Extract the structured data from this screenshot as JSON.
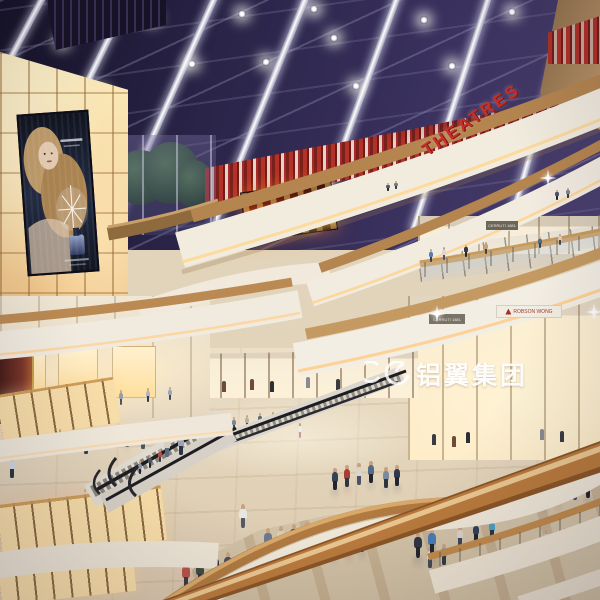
{
  "scene": {
    "title": "shopping-mall-atrium-night-render",
    "watermark": {
      "logo": "swirl-mark",
      "text": "铝翼集团"
    },
    "signs": {
      "theatres": "THEATRES",
      "store_3f": "CERRUTI 1881",
      "store_2f_left": "CERRUTI 1881",
      "store_2f_right": "ROBSON WONG"
    },
    "colors": {
      "sky": "#2a2446",
      "beam_white": "#e8e8f2",
      "red_accent": "#b5322a",
      "wood": "#b5854f",
      "amber_glow": "#f5d9a4",
      "fascia_white": "#f2ecdf",
      "floor_beige": "#e2d4ba",
      "fire_screen_orange": "#ff8a1e",
      "watermark": "#ffffff"
    }
  },
  "people": [
    [
      557,
      200,
      10,
      "#4a5568",
      "#23242e",
      "f"
    ],
    [
      568,
      198,
      10,
      "#7a8698",
      "#333a44",
      "f"
    ],
    [
      388,
      191,
      8,
      "#555a66",
      "#22262e",
      "f"
    ],
    [
      396,
      189,
      8,
      "#787888",
      "#333a44",
      "f"
    ],
    [
      431,
      262,
      13,
      "#5a7ab0",
      "#39404e",
      "f"
    ],
    [
      444,
      260,
      13,
      "#d8d8d8",
      "#4a5266",
      "f"
    ],
    [
      466,
      257,
      12,
      "#333a46",
      "#23242e",
      "f"
    ],
    [
      486,
      254,
      12,
      "#c8a07a",
      "#39404e",
      "f"
    ],
    [
      540,
      248,
      11,
      "#556a88",
      "#334455",
      "f"
    ],
    [
      560,
      245,
      11,
      "#d8ccc0",
      "#444a55",
      "f"
    ],
    [
      100,
      408,
      16,
      "#c89aa0",
      "#4a5266",
      "f"
    ],
    [
      121,
      405,
      15,
      "#8898b0",
      "#39404e",
      "f"
    ],
    [
      148,
      402,
      14,
      "#aab8c4",
      "#333a44",
      "f"
    ],
    [
      170,
      400,
      13,
      "#98a8b8",
      "#444a55",
      "f"
    ],
    [
      221,
      432,
      13,
      "#9aa8b8",
      "#333a44",
      "f"
    ],
    [
      234,
      430,
      13,
      "#7a8698",
      "#444a55",
      "f"
    ],
    [
      247,
      428,
      13,
      "#b8b0a0",
      "#333a44",
      "f"
    ],
    [
      260,
      426,
      13,
      "#5a6878",
      "#22262e",
      "f"
    ],
    [
      273,
      425,
      13,
      "#8a98a8",
      "#333a44",
      "f"
    ],
    [
      58,
      520,
      19,
      "#baa89a",
      "#44506b",
      "f"
    ],
    [
      78,
      515,
      19,
      "#8fa0b5",
      "#333a44",
      "f"
    ],
    [
      42,
      532,
      18,
      "#c8d0b8",
      "#444a55",
      "f"
    ],
    [
      20,
      538,
      18,
      "#a8b8c8",
      "#333a44",
      "f"
    ],
    [
      85,
      506,
      17,
      "#d8c8b8",
      "#444a55",
      "f"
    ],
    [
      335,
      490,
      22,
      "#334455",
      "#23242e",
      "m"
    ],
    [
      347,
      487,
      22,
      "#aa3c36",
      "#2e3440",
      "m"
    ],
    [
      359,
      485,
      22,
      "#d8d5cc",
      "#4a5266",
      "m"
    ],
    [
      371,
      483,
      22,
      "#556a85",
      "#23242e",
      "m"
    ],
    [
      386,
      488,
      21,
      "#7a8ba0",
      "#2e3440",
      "m"
    ],
    [
      397,
      486,
      21,
      "#2e3a4e",
      "#23242e",
      "m"
    ],
    [
      127,
      447,
      19,
      "#b08a88",
      "#444a55",
      "m"
    ],
    [
      143,
      449,
      19,
      "#d8d0a8",
      "#45556a",
      "m"
    ],
    [
      86,
      454,
      19,
      "#c8cdd8",
      "#333a44",
      "m"
    ],
    [
      60,
      447,
      18,
      "#8888aa",
      "#333a44",
      "m"
    ],
    [
      12,
      478,
      21,
      "#d0d8e0",
      "#2e3440",
      "m"
    ],
    [
      167,
      457,
      21,
      "#d8cfc2",
      "#5a6a80",
      "m"
    ],
    [
      181,
      455,
      21,
      "#9aa5b5",
      "#2e3440",
      "m"
    ],
    [
      515,
      510,
      23,
      "#4aa3cc",
      "#2e3440",
      "m"
    ],
    [
      530,
      507,
      23,
      "#d8d0c2",
      "#4a5266",
      "m"
    ],
    [
      545,
      505,
      23,
      "#2f4a6e",
      "#23242e",
      "m"
    ],
    [
      558,
      503,
      23,
      "#8a5a4a",
      "#2e3440",
      "m"
    ],
    [
      575,
      500,
      22,
      "#c8b8a8",
      "#44506b",
      "m"
    ],
    [
      588,
      498,
      22,
      "#3a4a5a",
      "#23242e",
      "m"
    ],
    [
      268,
      552,
      24,
      "#6a7a8e",
      "#2e3440",
      "m"
    ],
    [
      281,
      550,
      24,
      "#d6cec0",
      "#4a5266",
      "m"
    ],
    [
      294,
      548,
      24,
      "#47525f",
      "#23242e",
      "m"
    ],
    [
      307,
      545,
      23,
      "#2e3a4a",
      "#1e2028",
      "m"
    ],
    [
      334,
      558,
      24,
      "#8795a5",
      "#333a44",
      "m"
    ],
    [
      349,
      555,
      24,
      "#b0443a",
      "#2e3440",
      "m"
    ],
    [
      362,
      552,
      24,
      "#3c4654",
      "#23242e",
      "m"
    ],
    [
      430,
      568,
      21,
      "#d8d8d8",
      "#444a55",
      "m"
    ],
    [
      444,
      565,
      21,
      "#8899aa",
      "#333a44",
      "m"
    ],
    [
      418,
      558,
      26,
      "#2e3440",
      "#23242e",
      "m"
    ],
    [
      432,
      555,
      27,
      "#4a7ab5",
      "#23242e",
      "m"
    ],
    [
      460,
      546,
      20,
      "#d8d2c8",
      "#3c4658",
      "m"
    ],
    [
      476,
      542,
      20,
      "#2f3f58",
      "#23242e",
      "m"
    ],
    [
      492,
      538,
      19,
      "#4a9ec4",
      "#2e3440",
      "m"
    ],
    [
      186,
      588,
      27,
      "#b8524a",
      "#3a3a44",
      "m"
    ],
    [
      200,
      586,
      28,
      "#3f4a3f",
      "#2e3440",
      "m"
    ],
    [
      215,
      580,
      27,
      "#2e3846",
      "#23242e",
      "m"
    ],
    [
      228,
      578,
      26,
      "#454f5e",
      "#23242e",
      "m"
    ],
    [
      243,
      528,
      24,
      "#e8e6e0",
      "#555a66",
      "m"
    ],
    [
      546,
      548,
      18,
      "#cfc4b4",
      "#4a4456",
      "m"
    ],
    [
      565,
      545,
      17,
      "#e8e8e6",
      "#555a66",
      "m"
    ],
    [
      577,
      543,
      17,
      "#2e3440",
      "#22262e",
      "m"
    ],
    [
      590,
      541,
      17,
      "#5577aa",
      "#333a44",
      "m"
    ],
    [
      150,
      468,
      13,
      "#445566",
      "#22262e",
      "m"
    ],
    [
      160,
      462,
      13,
      "#b05048",
      "#333a44",
      "m"
    ],
    [
      140,
      474,
      13,
      "#8898b0",
      "#22262e",
      "m"
    ],
    [
      300,
      438,
      15,
      "#ececea",
      "#c89aa0",
      "m"
    ]
  ],
  "sparkles": [
    [
      548,
      178
    ],
    [
      437,
      314
    ],
    [
      594,
      312
    ]
  ],
  "mannequins": [
    [
      432,
      445
    ],
    [
      452,
      447
    ],
    [
      466,
      443
    ],
    [
      540,
      440
    ],
    [
      560,
      442
    ],
    [
      250,
      390
    ],
    [
      270,
      392
    ],
    [
      306,
      388
    ],
    [
      336,
      390
    ],
    [
      222,
      392
    ]
  ]
}
